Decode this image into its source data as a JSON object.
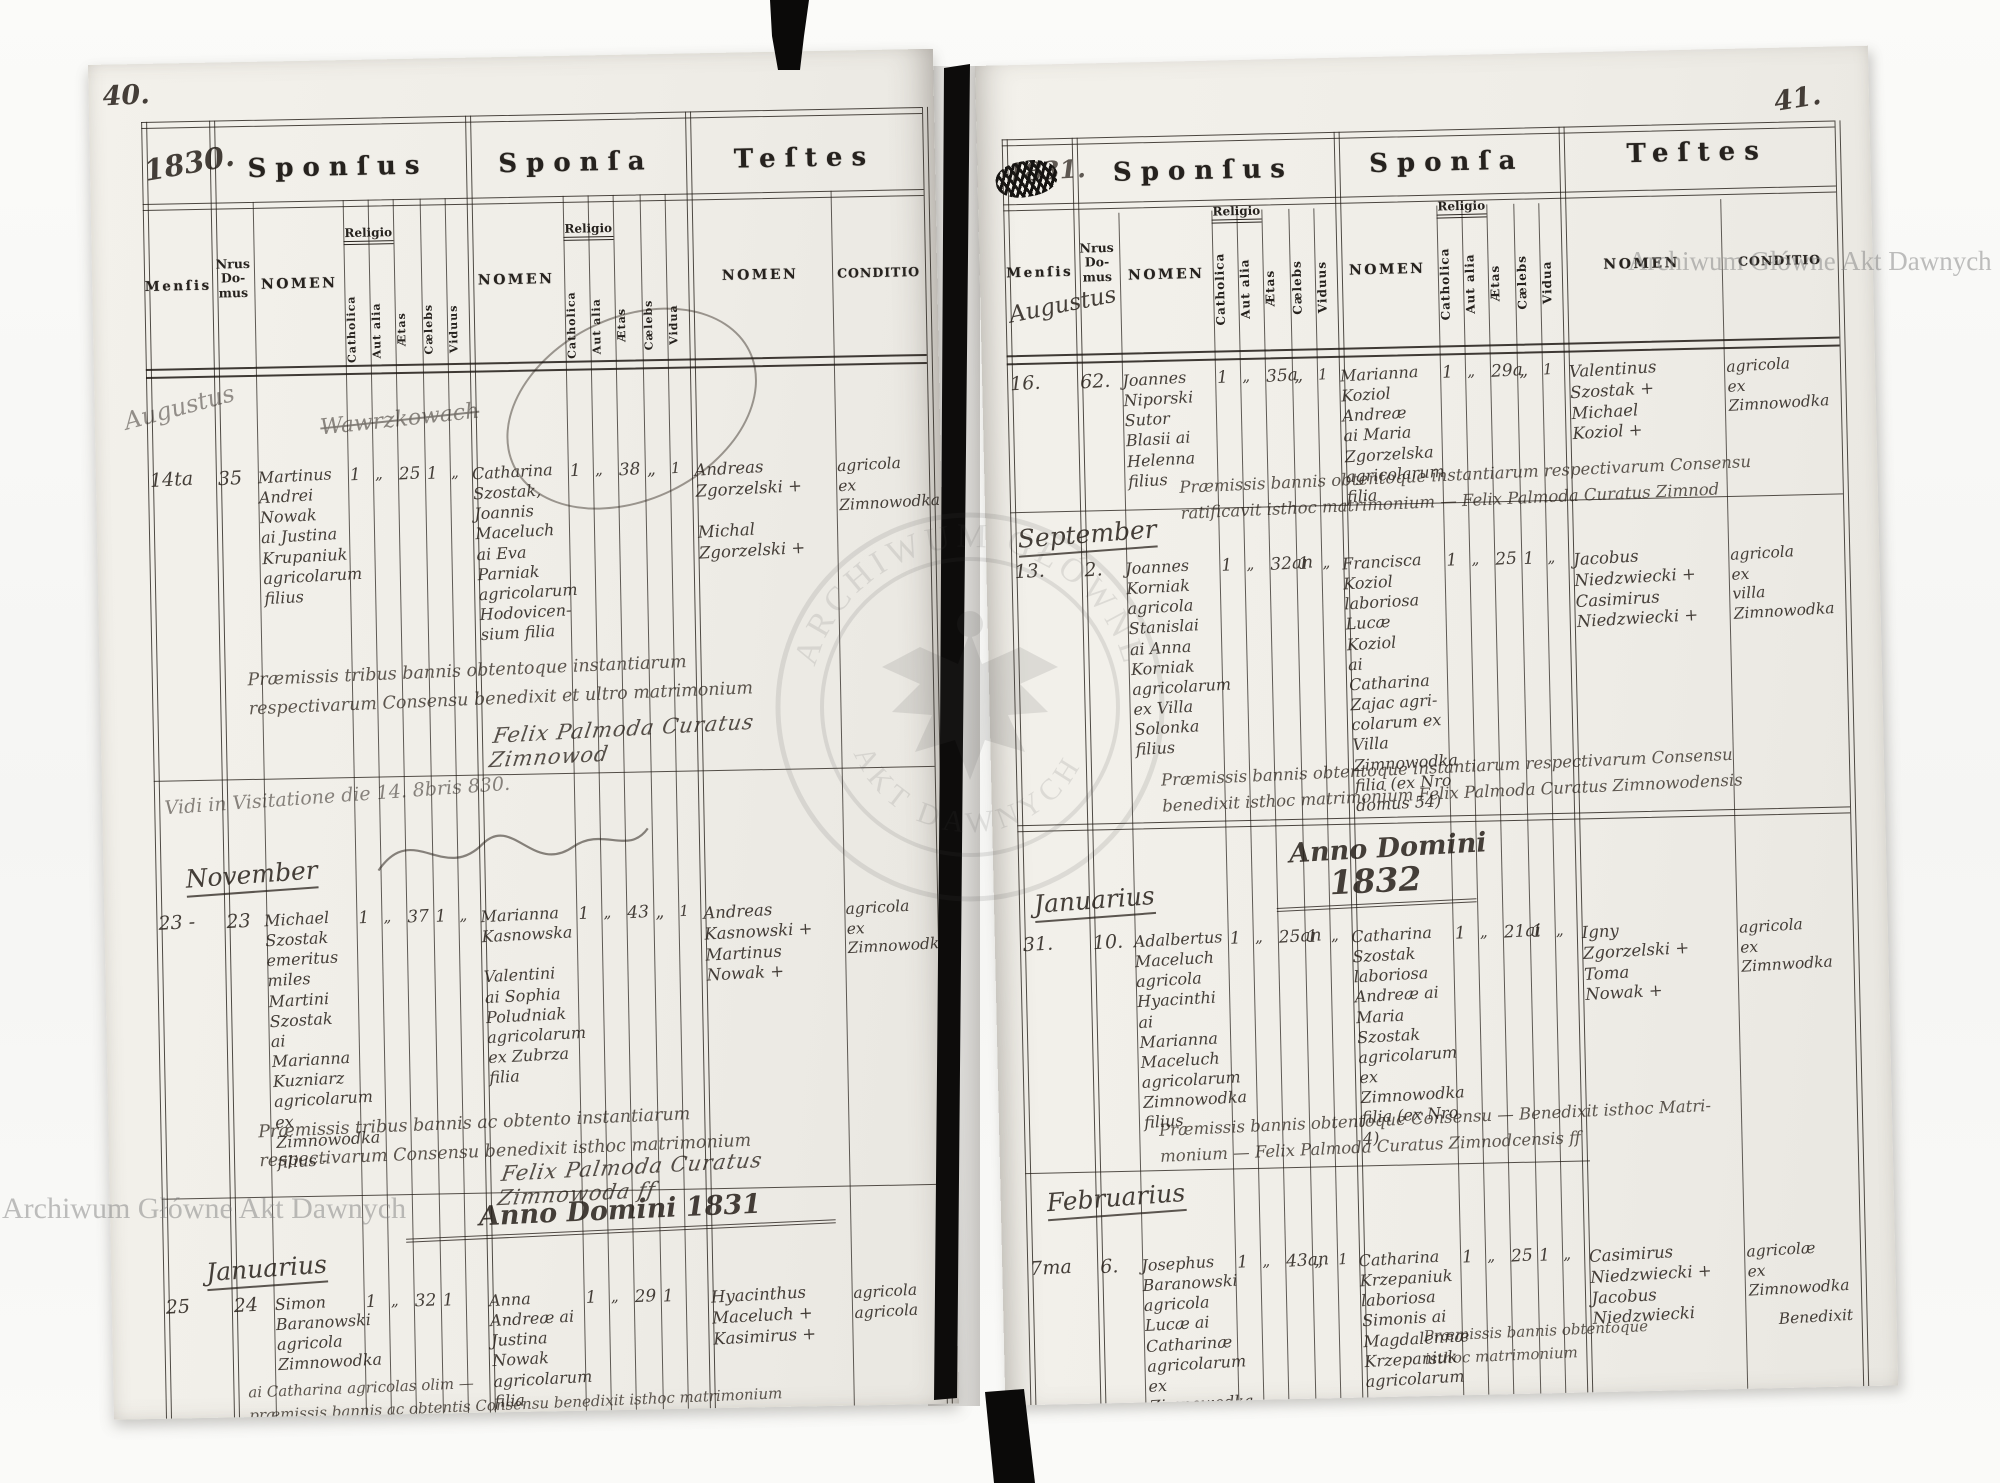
{
  "watermark": {
    "text": "Archiwum Główne Akt Dawnych",
    "seal_top": "ARCHIWUM GŁÓWNE",
    "seal_bottom": "AKT DAWNYCH"
  },
  "form": {
    "sponsus": "Sponſus",
    "sponsa": "Sponſa",
    "testes": "Teſtes",
    "mensis": "Menſis",
    "nrus_domus": "Nrus\nDo-\nmus",
    "nomen": "NOMEN",
    "religio": "Religio",
    "catholica": "Catholica",
    "aut_alia": "Aut alia",
    "aetas": "Ætas",
    "caelebs": "Cælebs",
    "viduus": "Viduus",
    "vidua": "Vidua",
    "conditio": "CONDITIO"
  },
  "left_page": {
    "page_number": "40.",
    "year_box": "1830.",
    "month_august": "Augustus",
    "scribble": "Wawrzkowach",
    "entries": [
      {
        "date": "14ta",
        "house": "35",
        "sponsus": "Martinus\nAndrei\nNowak\nai Justina\nKrupaniuk\nagricolarum\nfilius",
        "s_cath": "1",
        "s_aut": "„",
        "s_aetas": "25",
        "s_cael": "1",
        "s_vid": "„",
        "sponsa": "Catharina\nSzostak,\nJoannis\nMaceluch\nai Eva\nParniak\nagricolarum\nHodovicen-\nsium filia",
        "p_cath": "1",
        "p_aut": "„",
        "p_aetas": "38",
        "p_cael": "„",
        "p_vid": "1",
        "testes": "Andreas\nZgorzelski +\n\nMichal\nZgorzelski +",
        "conditio": "agricola\nex\nZimnowodka"
      },
      {
        "date": "23 -",
        "house": "23",
        "sponsus": "Michael\nSzostak\nemeritus\nmiles\nMartini\nSzostak\nai Marianna\nKuzniarz\nagricolarum\nex Zimnowodka\nfilius -",
        "s_cath": "1",
        "s_aut": "„",
        "s_aetas": "37",
        "s_cael": "1",
        "s_vid": "„",
        "sponsa": "Marianna\nKasnowska\n\nValentini\nai Sophia\nPoludniak\nagricolarum\nex Zubrza\nfilia",
        "p_cath": "1",
        "p_aut": "„",
        "p_aetas": "43",
        "p_cael": "„",
        "p_vid": "1",
        "testes": "Andreas\nKasnowski +\nMartinus\nNowak +",
        "conditio": "agricola\nex\nZimnowodka"
      },
      {
        "date": "25",
        "house": "24",
        "sponsus": "Simon\nBaranowski\nagricola\nZimnowodka",
        "s_cath": "1",
        "s_aut": "„",
        "s_aetas": "32",
        "s_cael": "1",
        "s_vid": "",
        "sponsa": "Anna\nAndreæ ai\nJustina\nNowak\nagricolarum filia",
        "p_cath": "1",
        "p_aut": "„",
        "p_aetas": "29",
        "p_cael": "1",
        "p_vid": "",
        "testes": "Hyacinthus\nMaceluch +\nKasimirus +",
        "conditio": "agricola\nagricola"
      }
    ],
    "formula_1": "Præmissis tribus bannis obtentoque instantiarum\nrespectivarum Consensu benedixit et ultro matrimonium",
    "signature_1": "Felix Palmoda Curatus Zimnowod",
    "visitation": "Vidi in Visitatione die 14. 8bris 830.",
    "month_november": "November",
    "formula_2": "Præmissis tribus bannis ac obtento instantiarum\nrespectivarum Consensu benedixit isthoc matrimonium",
    "signature_2": "Felix Palmoda Curatus Zimnowoda ff",
    "year_heading": "Anno Domini 1831",
    "month_january": "Januarius",
    "bottom_lines": "ai Catharina agricolas olim —\npræmissis bannis ac obtentis Consensu benedixit isthoc matrimonium"
  },
  "right_page": {
    "page_number": "41.",
    "year_box": "1831.",
    "month_august": "Augustus",
    "entries": [
      {
        "date": "16.",
        "house": "62.",
        "sponsus": "Joannes\nNiporski\nSutor\nBlasii ai\nHelenna\nfilius",
        "s_cath": "1",
        "s_aut": "„",
        "s_aetas": "35a",
        "s_cael": "„",
        "s_vid": "1",
        "sponsa": "Marianna\nKoziol\nAndreæ\nai Maria\nZgorzelska\nagricolarum\nfilia",
        "p_cath": "1",
        "p_aut": "„",
        "p_aetas": "29a",
        "p_cael": "„",
        "p_vid": "1",
        "testes": "Valentinus\nSzostak +\nMichael\nKoziol +",
        "conditio": "agricola\nex\nZimnowodka"
      },
      {
        "date": "13.",
        "house": "2.",
        "sponsus": "Joannes\nKorniak\nagricola\nStanislai\nai Anna\nKorniak\nagricolarum\nex Villa\nSolonka\nfilius",
        "s_cath": "1",
        "s_aut": "„",
        "s_aetas": "32an",
        "s_cael": "1",
        "s_vid": "„",
        "sponsa": "Francisca\nKoziol\nlaboriosa\nLucæ Koziol\nai Catharina\nZajac agri-\ncolarum ex\nVilla Zimnowodka\nfilia (ex Nro\ndomus 54)",
        "p_cath": "1",
        "p_aut": "„",
        "p_aetas": "25",
        "p_cael": "1",
        "p_vid": "„",
        "testes": "Jacobus\nNiedzwiecki +\nCasimirus\nNiedzwiecki +",
        "conditio": "agricola\nex\nvilla\nZimnowodka"
      },
      {
        "date": "31.",
        "house": "10.",
        "sponsus": "Adalbertus\nMaceluch\nagricola\nHyacinthi\nai Marianna\nMaceluch\nagricolarum\nZimnowodka\nfilius",
        "s_cath": "1",
        "s_aut": "„",
        "s_aetas": "25an",
        "s_cael": "1",
        "s_vid": "„",
        "sponsa": "Catharina\nSzostak\nlaboriosa\nAndreæ ai\nMaria Szostak\nagricolarum\nex Zimnowodka\nfilia (ex Nro 4)",
        "p_cath": "1",
        "p_aut": "„",
        "p_aetas": "21ai",
        "p_cael": "1",
        "p_vid": "„",
        "testes": "Igny\nZgorzelski +\nToma\nNowak +",
        "conditio": "agricola\nex\nZimnwodka"
      },
      {
        "date": "7ma",
        "house": "6.",
        "sponsus": "Josephus\nBaranowski\nagricola\nLucæ ai Catharinæ\nagricolarum ex\nZimnowodka filius",
        "s_cath": "1",
        "s_aut": "„",
        "s_aetas": "43an",
        "s_cael": "„",
        "s_vid": "1",
        "sponsa": "Catharina\nKrzepaniuk\nlaboriosa\nSimonis ai\nMagdalennæ\nKrzepaniuk\nagricolarum ex\nZimnowodka № 43\nfilia",
        "p_cath": "1",
        "p_aut": "„",
        "p_aetas": "25",
        "p_cael": "1",
        "p_vid": "„",
        "testes": "Casimirus\nNiedzwiecki +\nJacobus\nNiedzwiecki",
        "conditio": "agricolæ\nex Zimnowodka"
      }
    ],
    "formula_1": "Præmissis bannis obtentoque instantiarum respectivarum Consensu\nratificavit isthoc matrimonium — Felix Palmoda Curatus Zimnod",
    "month_september": "September",
    "formula_2": "Præmissis bannis obtentoque instantiarum respectivarum Consensu\nbenedixit isthoc matrimonium  Felix Palmoda Curatus Zimnowodensis",
    "year_heading_line1": "Anno Domini",
    "year_heading_line2": "1832",
    "month_january": "Januarius",
    "formula_3": "Præmissis bannis obtentoque Consensu — Benedixit isthoc Matri-\nmonium — Felix Palmoda Curatus Zimnodcensis ff",
    "month_february": "Februarius",
    "formula_4": "Præmissis bannis obtentoque\nisthoc matrimonium",
    "benedixit": "Benedixit"
  }
}
